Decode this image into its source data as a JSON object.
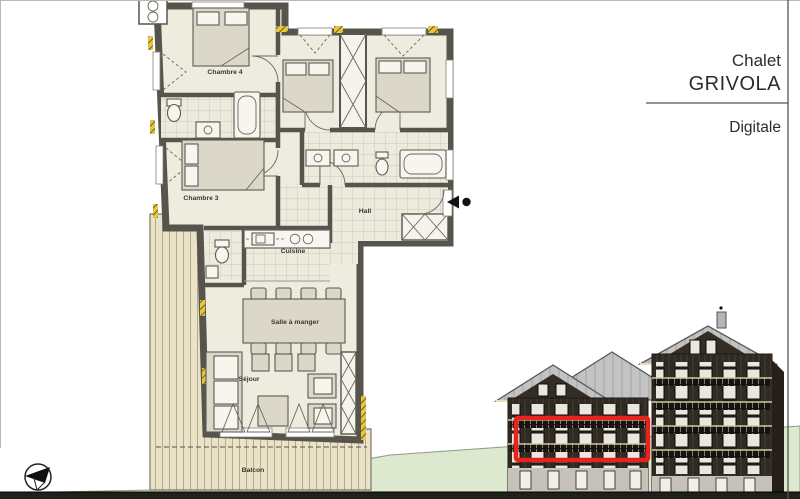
{
  "title_block": {
    "chalet_label": "Chalet",
    "chalet_name": "GRIVOLA",
    "apartment_name": "Digitale"
  },
  "floor_plan": {
    "rooms": {
      "chambre_4": "Chambre 4",
      "chambre_3": "Chambre 3",
      "hall": "Hall",
      "cuisine": "Cuisine",
      "salle_a_manger": "Salle à manger",
      "sejour": "Séjour",
      "balcon": "Balcon"
    }
  },
  "elevation": {
    "highlighted_unit": "Digitale",
    "highlight_shape": "red-rectangle"
  },
  "icons": {
    "north_arrow": "north-arrow-compass",
    "entrance_marker": "entrance-direction-marker"
  },
  "colors": {
    "wall": "#57544c",
    "floor": "#edecdf",
    "deck_wood": "#eae3c8",
    "insulation_yellow": "#e7c53d",
    "terrain_green": "#dde9cf",
    "roof_gray": "#c3c3c3",
    "facade_dark": "#2f2a22",
    "ground_strip": "#20201a",
    "highlight_red": "#e8231c"
  }
}
